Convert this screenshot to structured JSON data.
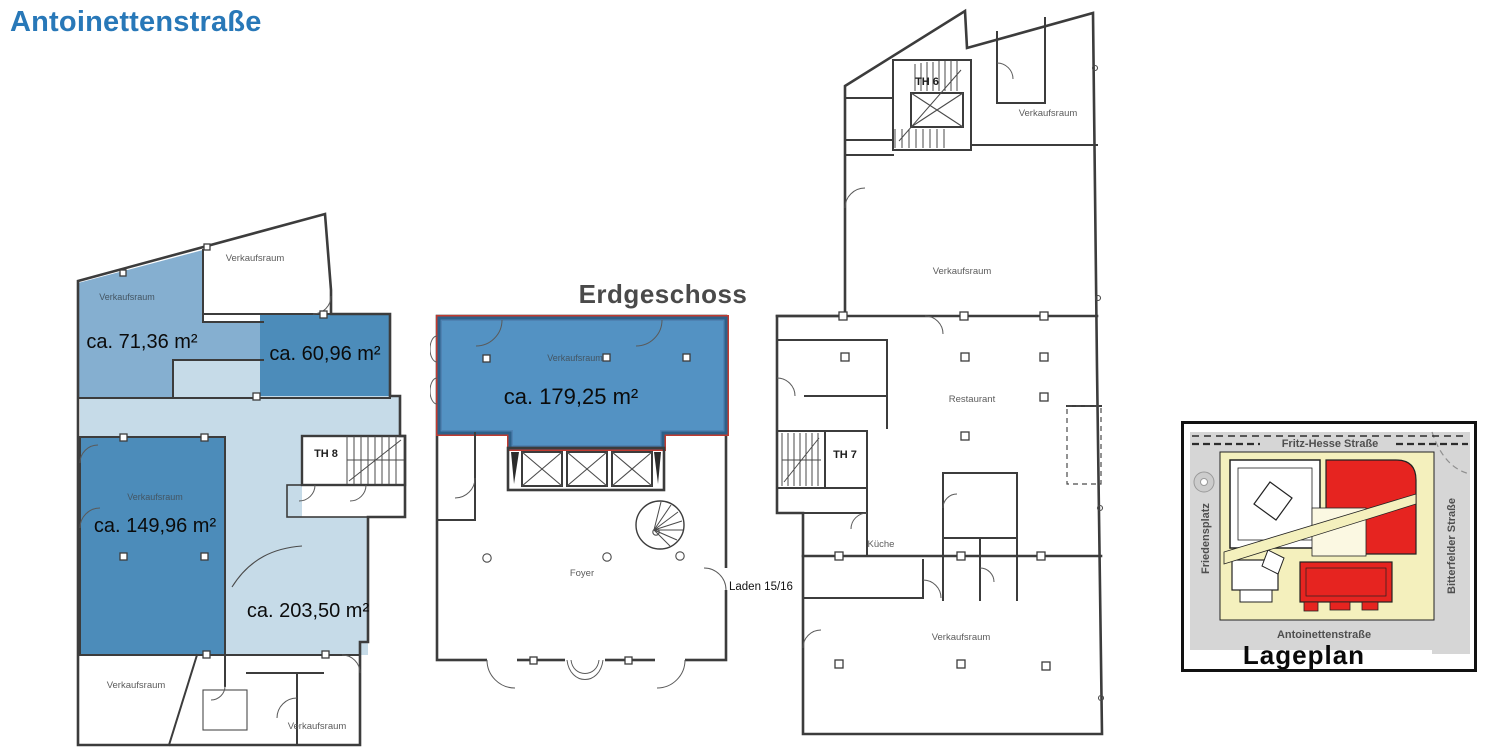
{
  "page": {
    "title": "Antoinettenstraße"
  },
  "colors": {
    "title_blue": "#2878b8",
    "heading_gray": "#4a4a4a",
    "wall": "#3c3c3c",
    "highlight_dark": "#4c8cba",
    "highlight_medium": "#85afd0",
    "highlight_light": "#c6dbe8",
    "highlight_main": "#4489be",
    "highlight_border_blue": "#2d6089",
    "highlight_border_red": "#c03a30",
    "map_red": "#e62420",
    "map_yellow": "#f4f0bd",
    "map_courtyard": "#fbf8e2",
    "map_street": "#d6d6d6"
  },
  "left_plan": {
    "room_top_left": "Verkaufsraum",
    "room_top_right": "Verkaufsraum",
    "area_top_left": "ca. 71,36 m²",
    "area_top_right": "ca. 60,96 m²",
    "room_mid": "Verkaufsraum",
    "area_mid": "ca. 149,96 m²",
    "area_light": "ca. 203,50 m²",
    "stairwell": "TH 8",
    "room_bottom_left": "Verkaufsraum",
    "room_bottom_right": "Verkaufsraum"
  },
  "middle_plan": {
    "heading": "Erdgeschoss",
    "room": "Verkaufsraum",
    "area": "ca. 179,25 m²",
    "foyer": "Foyer",
    "shop_note": "Laden 15/16"
  },
  "right_plan": {
    "stairwell_top": "TH 6",
    "room_top": "Verkaufsraum",
    "room_mid": "Verkaufsraum",
    "restaurant": "Restaurant",
    "stairwell_mid": "TH 7",
    "kitchen": "Küche",
    "room_bottom": "Verkaufsraum"
  },
  "lageplan": {
    "title": "Lageplan",
    "street_top": "Fritz-Hesse Straße",
    "street_left": "Friedensplatz",
    "street_right": "Bitterfelder Straße",
    "street_bottom": "Antoinettenstraße"
  }
}
